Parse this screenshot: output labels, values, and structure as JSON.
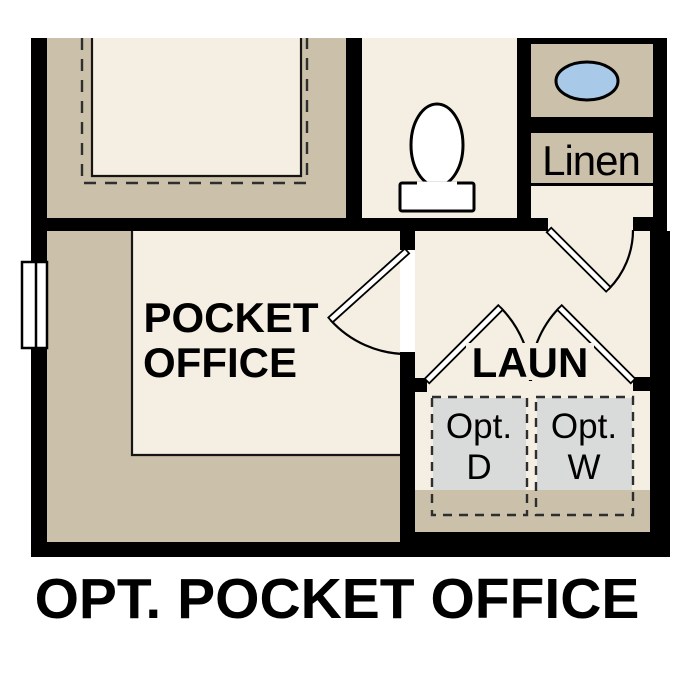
{
  "title": "OPT. POCKET OFFICE",
  "rooms": {
    "pocket_office": {
      "label_lines": [
        "POCKET",
        "OFFICE"
      ]
    },
    "laundry": {
      "label": "LAUN"
    },
    "linen_closet": {
      "label": "Linen"
    },
    "appliances": {
      "dryer": {
        "line1": "Opt.",
        "line2": "D"
      },
      "washer": {
        "line1": "Opt.",
        "line2": "W"
      }
    }
  },
  "fixtures": [
    "toilet",
    "sink",
    "window",
    "door-swings"
  ],
  "colors": {
    "background": "#ffffff",
    "wall": "#000000",
    "floor_light": "#f5eee2",
    "floor_dark": "#cbc0a9",
    "appliance": "#d9dbda",
    "sink": "#a9c9e9",
    "dash": "#2e2e2e",
    "text": "#000000"
  }
}
